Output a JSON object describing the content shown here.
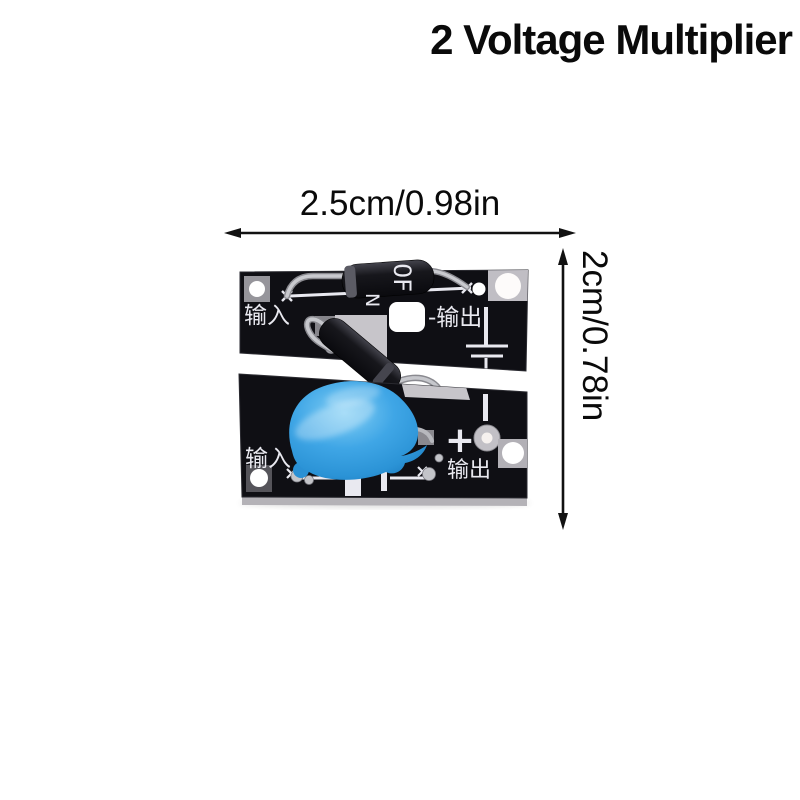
{
  "product": {
    "title": "2 Voltage Multiplier"
  },
  "dimensions": {
    "width": "2.5cm/0.98in",
    "height": "2cm/0.78in"
  },
  "board": {
    "top": {
      "input": "输入",
      "output": "-输出"
    },
    "bottom": {
      "input": "输入",
      "plus": "+",
      "output": "输出"
    },
    "diode_marking": {
      "line1": "0F",
      "line2": "N"
    }
  },
  "colors": {
    "background": "#ffffff",
    "annotation_text": "#0a0a0a",
    "pcb_black": "#0f0f14",
    "silkscreen_white": "#e9e9f0",
    "capacitor_blue": "#3fa6e6",
    "lead_silver": "#c0c1c6",
    "pad_grey": "#c7c5ca"
  }
}
